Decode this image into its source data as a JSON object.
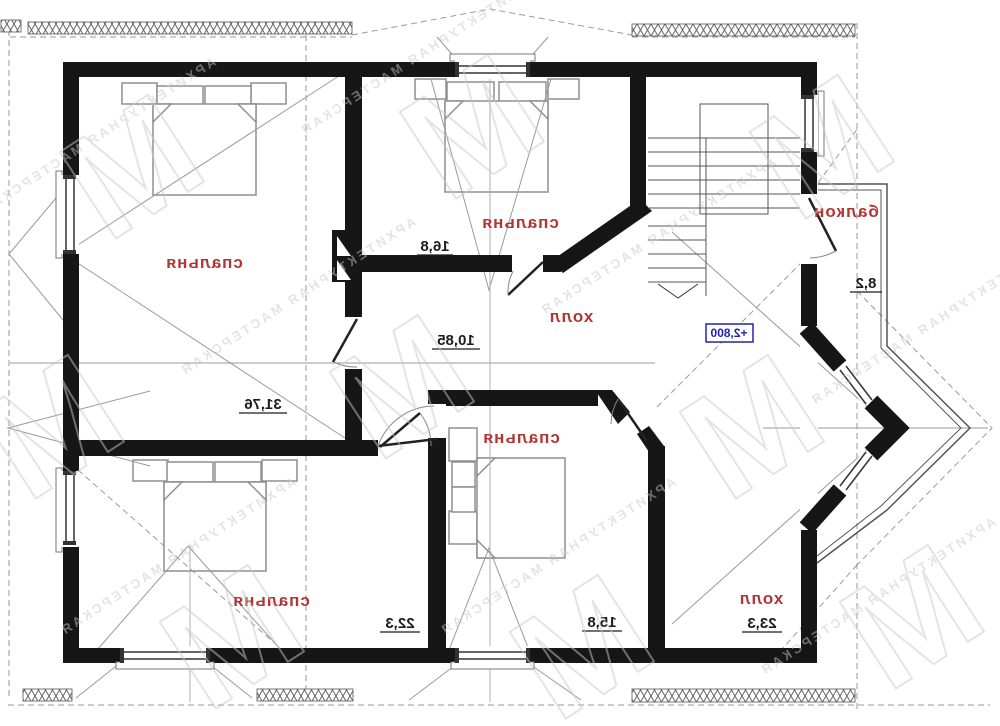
{
  "rooms": [
    {
      "id": "bedroom-top-left",
      "label": "спальня",
      "area": "31,76"
    },
    {
      "id": "bedroom-top-middle",
      "label": "спальня",
      "area": "16,8"
    },
    {
      "id": "hall-upper",
      "label": "холл",
      "area": "10,85"
    },
    {
      "id": "bedroom-bottom-left",
      "label": "спальня",
      "area": "22,3"
    },
    {
      "id": "bedroom-bottom-middle",
      "label": "спальня",
      "area": "15,8"
    },
    {
      "id": "hall-lower",
      "label": "холл",
      "area": "23,3"
    },
    {
      "id": "balcony",
      "label": "балкон",
      "area": "8,2"
    }
  ],
  "level_mark": "+2,800",
  "watermark": {
    "letter": "М",
    "text": "АРХИТЕКТУРНАЯ МАСТЕРСКАЯ"
  },
  "colors": {
    "room_label": "#b23734",
    "dimension": "#1c1c1c",
    "level_mark": "#2222b0",
    "wall": "#161616"
  }
}
